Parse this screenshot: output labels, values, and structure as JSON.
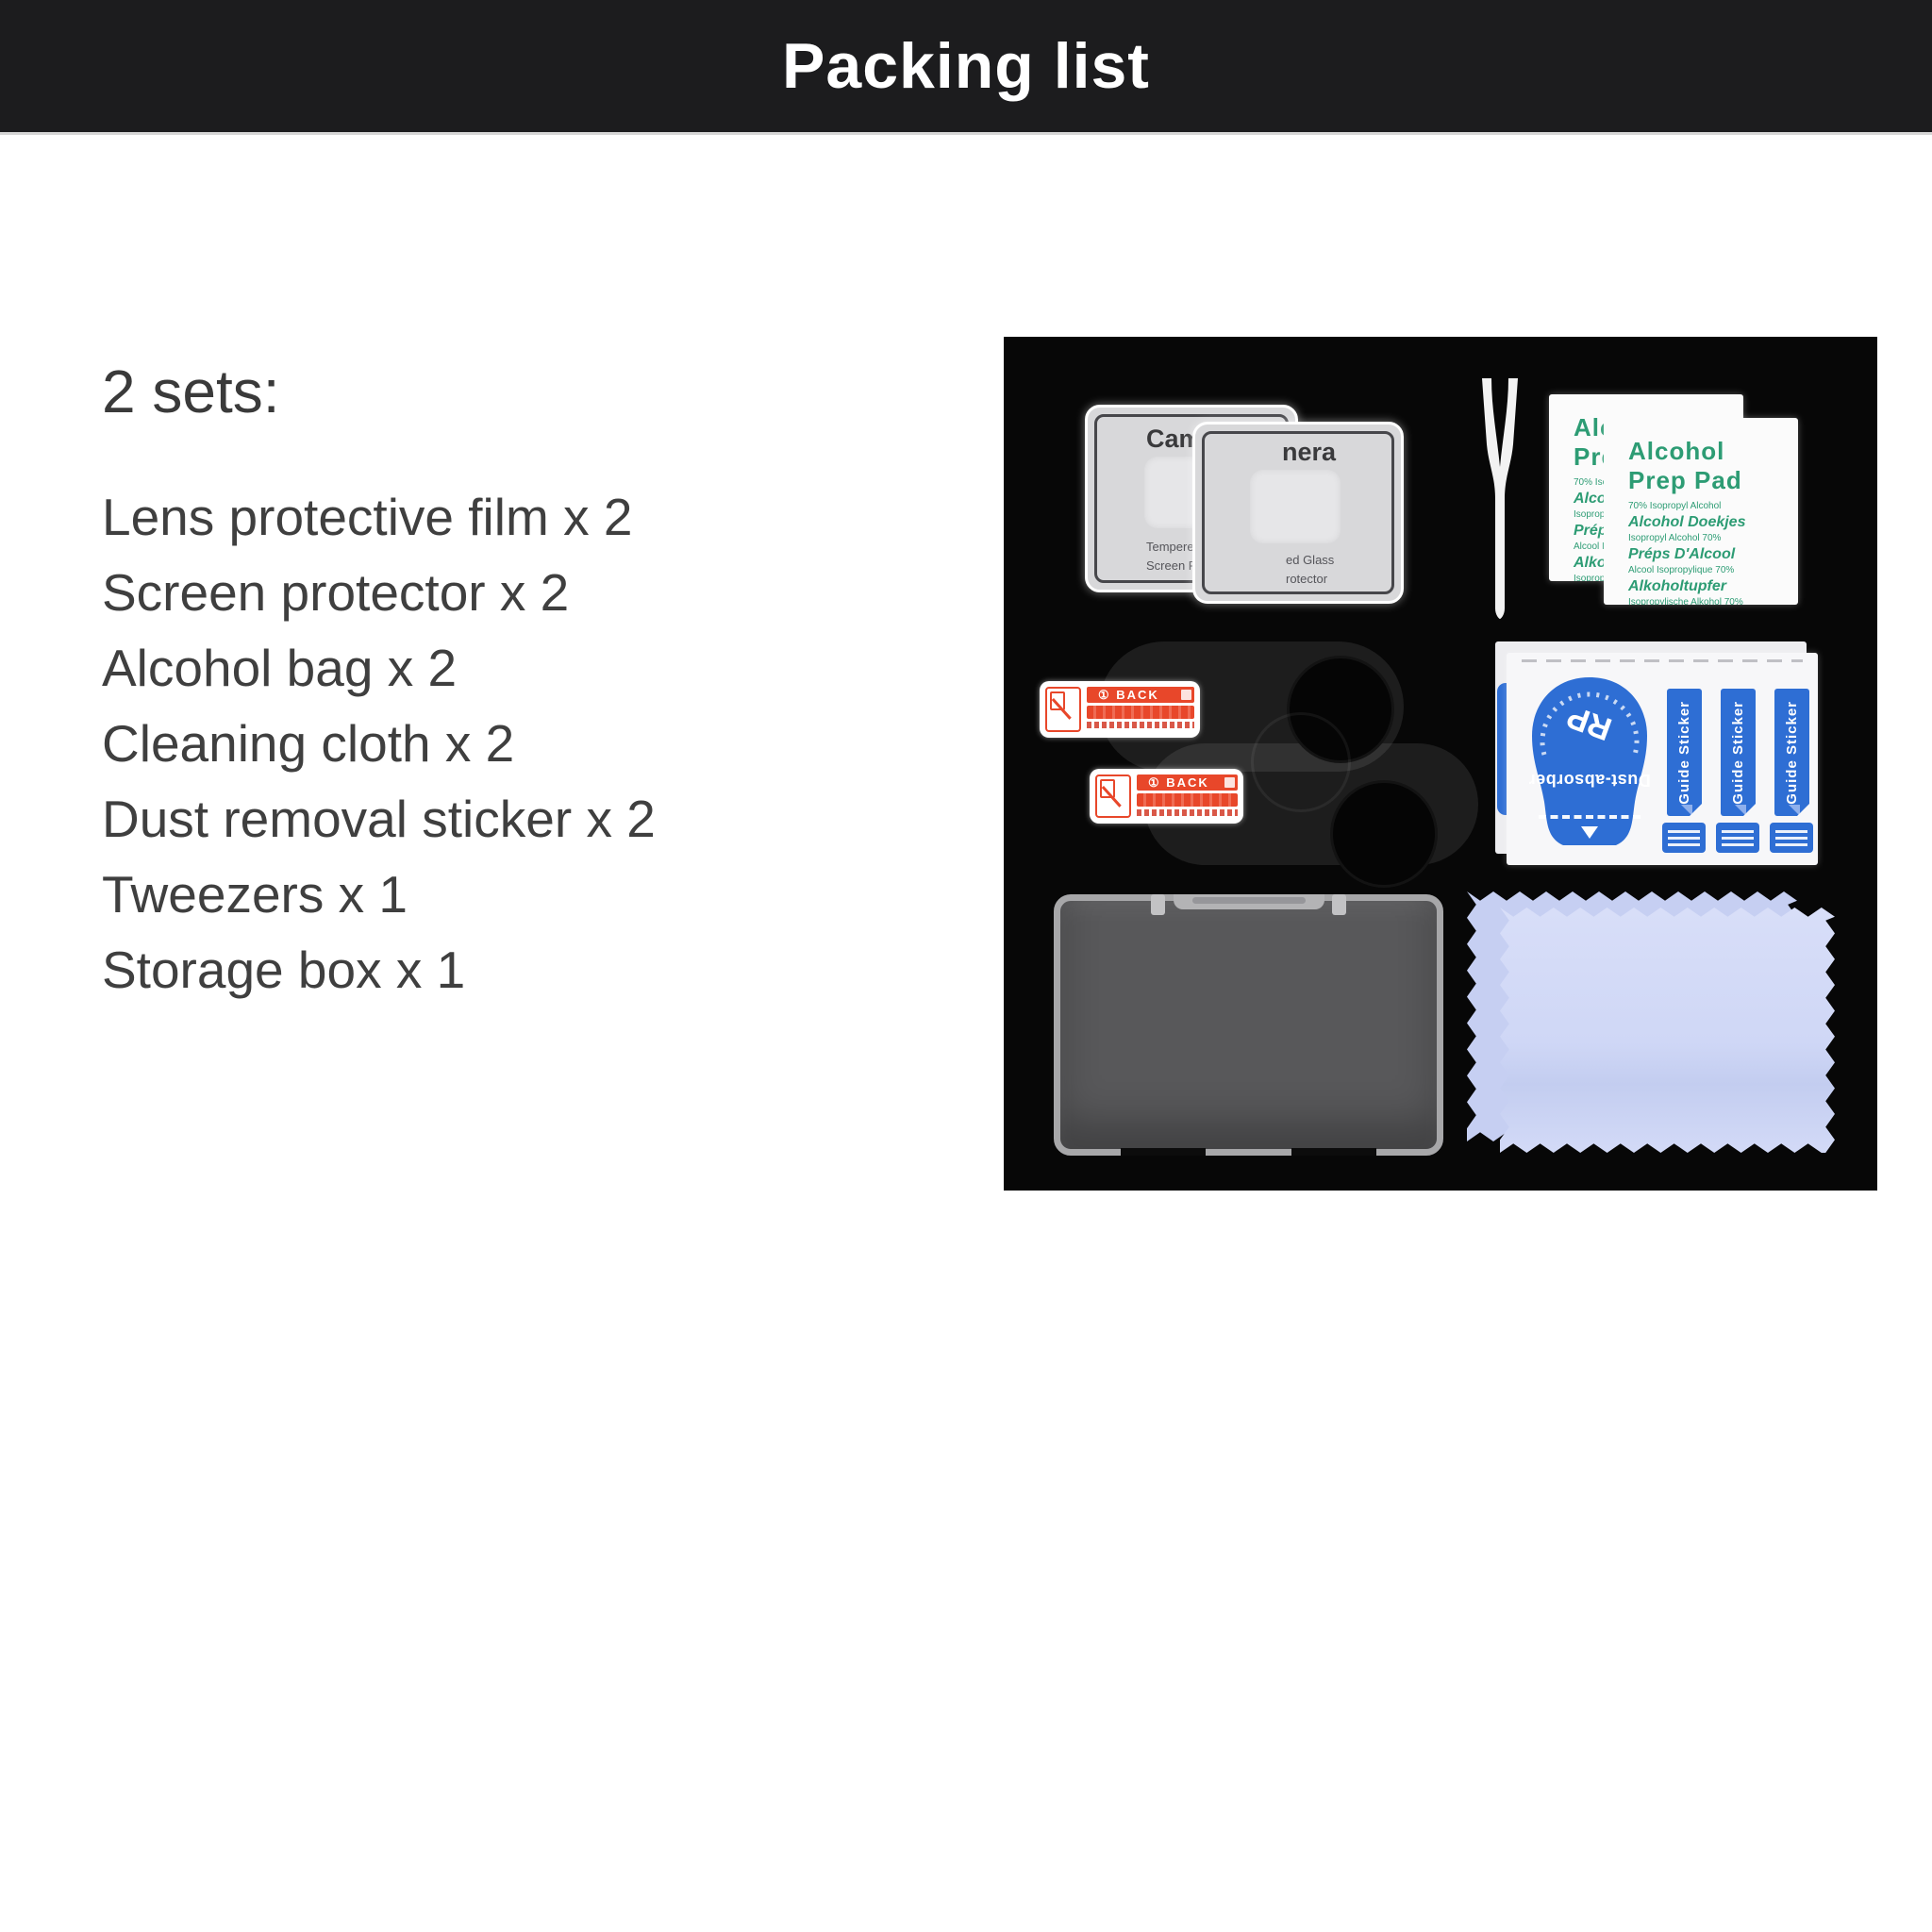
{
  "header": {
    "title": "Packing list"
  },
  "list": {
    "heading": "2 sets:",
    "items": [
      "Lens protective film x 2",
      "Screen protector x 2",
      "Alcohol bag x 2",
      "Cleaning cloth x 2",
      "Dust removal sticker x 2",
      "Tweezers x 1",
      "Storage box x 1"
    ]
  },
  "panel": {
    "camera_card_back": {
      "title": "Cam",
      "line1": "Tempere",
      "line2": "Screen P"
    },
    "camera_card_front": {
      "title": "nera",
      "line1": "ed Glass",
      "line2": "rotector"
    },
    "alcohol_pad": {
      "title_line1": "Alcohol",
      "title_line2": "Prep Pad",
      "lines": [
        "70% Isopropyl Alcohol",
        "Alcohol Doekjes",
        "Isopropyl Alcohol 70%",
        "Préps D'Alcool",
        "Alcool Isopropylique 70%",
        "Alkoholtupfer",
        "Isopropylische Alkohol 70%"
      ]
    },
    "back_sticker": {
      "label": "① BACK"
    },
    "guide_sheet": {
      "dust_absorber": "Dust-absorber",
      "guide_sticker": "Guide Sticker",
      "logo": "RP"
    }
  },
  "colors": {
    "header_bg": "#1c1c1e",
    "panel_bg": "#070707",
    "body_text": "#3f3f3f",
    "pad_green": "#2d9c74",
    "sticker_blue": "#2e6ed4",
    "back_sticker_red": "#e8472a",
    "cloth_lavender": "#ccd5f5"
  }
}
